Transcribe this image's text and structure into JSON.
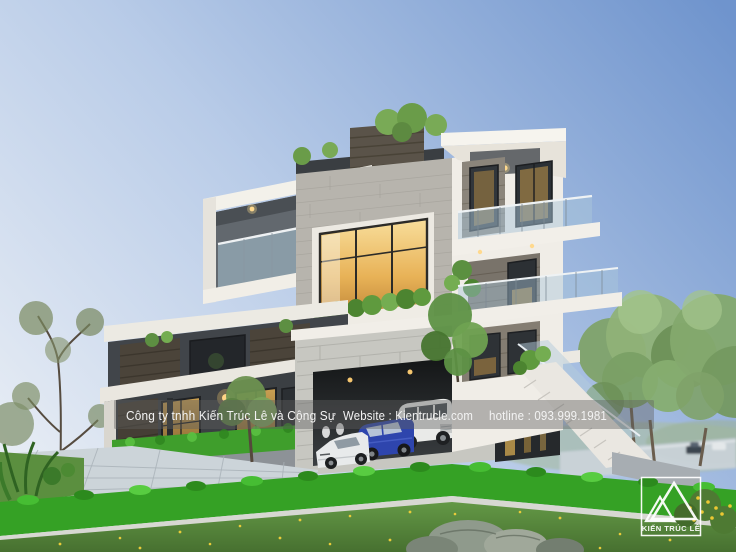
{
  "info_bar": {
    "company": "Công ty tnhh Kiến Trúc Lê và Cộng Sự",
    "website": "Website : Kientrucle.com",
    "hotline": "hotline : 093.999.1981"
  },
  "logo": {
    "brand": "KIẾN TRÚC LÊ"
  },
  "palette": {
    "sky_top": "#6f94cd",
    "sky_horizon": "#e9eef5",
    "wall_white": "#f0ede6",
    "wall_charcoal": "#3b3f43",
    "concrete_block": "#c7c7c1",
    "stone_dark": "#453e35",
    "window_glow": "#e8b257",
    "glass_blue": "#a9c6d9",
    "hedge_green": "#35a125",
    "lawn_green": "#5b9240",
    "overlay_bar": "#5f5f5f",
    "overlay_text": "#f3f3f3",
    "car_blue": "#2e45ad",
    "car_white": "#e9eae8"
  }
}
